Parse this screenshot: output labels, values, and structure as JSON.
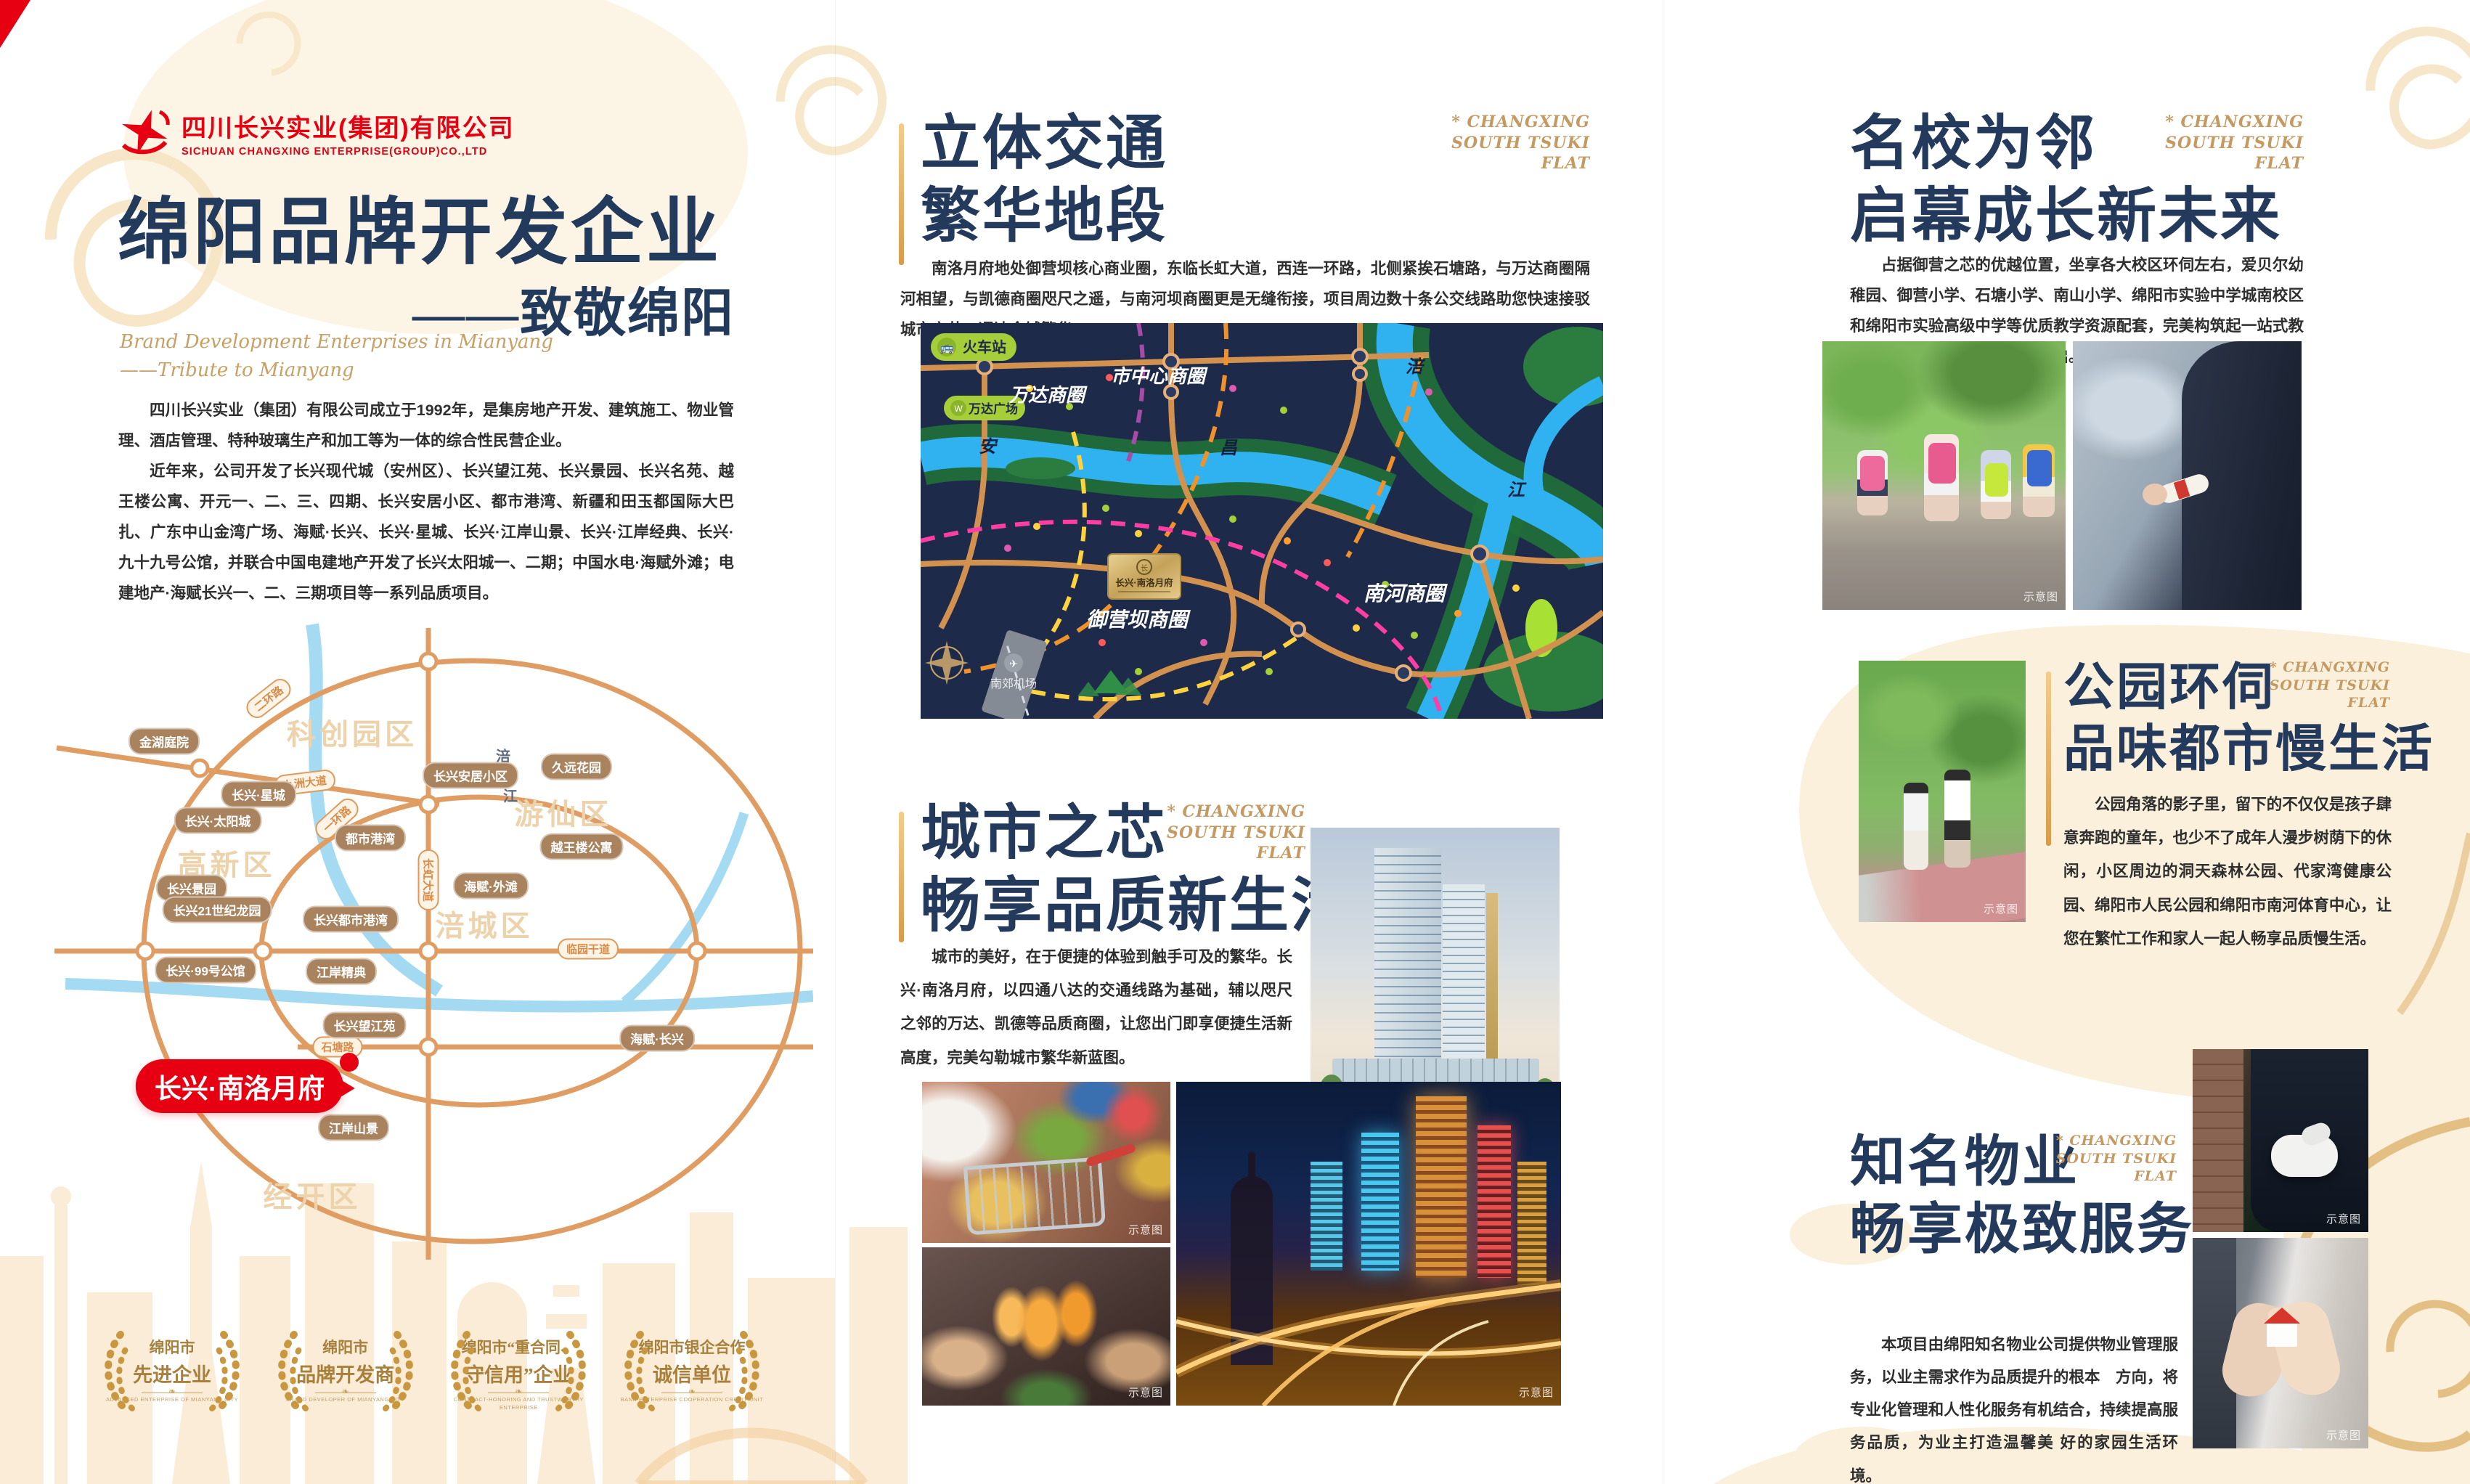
{
  "colors": {
    "accent_red": "#e60012",
    "navy_title": "#233a5c",
    "gold": "#c9a063",
    "map_road_orange": "#df9d63",
    "citymap_bg": "#1e2a4a",
    "green_pill": "#a6ce39",
    "cream": "#faf0dc"
  },
  "tag": {
    "l1": "* CHANGXING",
    "l2": "SOUTH TSUKI",
    "l3": "FLAT"
  },
  "watermarks": {
    "schematic": "示意图",
    "render": "效果图"
  },
  "logo": {
    "company_cn": "四川长兴实业(集团)有限公司",
    "company_en": "SICHUAN CHANGXING ENTERPRISE(GROUP)CO.,LTD"
  },
  "left": {
    "title": "绵阳品牌开发企业",
    "subtitle": "——致敬绵阳",
    "script1": "Brand Development Enterprises in Mianyang",
    "script2": "——Tribute to Mianyang",
    "para1": "四川长兴实业（集团）有限公司成立于1992年，是集房地产开发、建筑施工、物业管理、酒店管理、特种玻璃生产和加工等为一体的综合性民营企业。",
    "para2": "近年来，公司开发了长兴现代城（安州区）、长兴望江苑、长兴景园、长兴名苑、越王楼公寓、开元一、二、三、四期、长兴安居小区、都市港湾、新疆和田玉都国际大巴扎、广东中山金湾广场、海赋·长兴、长兴·星城、长兴·江岸山景、长兴·江岸经典、长兴·九十九号公馆，并联合中国电建地产开发了长兴太阳城一、二期；中国水电·海赋外滩；电建地产·海赋长兴一、二、三期项目等一系列品质项目。",
    "map": {
      "districts": [
        "科创园区",
        "游仙区",
        "高新区",
        "涪城区",
        "经开区"
      ],
      "roads": [
        "二环路",
        "九洲大道",
        "一环路",
        "长虹大道",
        "石塘路",
        "临园干道"
      ],
      "river_char1": "涪",
      "river_char2": "江",
      "projects": [
        "金湖庭院",
        "长兴·星城",
        "长兴·太阳城",
        "都市港湾",
        "长兴安居小区",
        "久远花园",
        "越王楼公寓",
        "海赋·外滩",
        "长兴景园",
        "长兴21世纪龙园",
        "长兴都市港湾",
        "长兴·99号公馆",
        "江岸精典",
        "长兴望江苑",
        "海赋·长兴",
        "江岸山景"
      ],
      "highlight": "长兴·南洛月府"
    },
    "badges": [
      {
        "line1": "绵阳市",
        "line2": "先进企业",
        "caption": "ADVANCED ENTERPRISE OF MIANYANG CITY"
      },
      {
        "line1": "绵阳市",
        "line2": "品牌开发商",
        "caption": "BRAND DEVELOPER OF MIANYANG CITY"
      },
      {
        "line1": "绵阳市“重合同、",
        "line2": "守信用”企业",
        "caption": "CONTRACT-HONORING AND TRUSTWORTHY ENTERPRISE"
      },
      {
        "line1": "绵阳市银企合作",
        "line2": "诚信单位",
        "caption": "BANK-ENTERPRISE COOPERATION CREDIT UNIT"
      }
    ]
  },
  "middle": {
    "s1": {
      "t1": "立体交通",
      "t2": "繁华地段",
      "para": "南洛月府地处御营坝核心商业圈，东临长虹大道，西连一环路，北侧紧挨石塘路，与万达商圈隔河相望，与凯德商圈咫尺之遥，与南河坝商圈更是无缝衔接，项目周边数十条公交线路助您快速接驳城市之芯，通达全城繁华。"
    },
    "map": {
      "station": "火车站",
      "wanda_plaza": "万达广场",
      "wanda_cbd": "万达商圈",
      "center_cbd": "市中心商圈",
      "nanhe_cbd": "南河商圈",
      "yuying_cbd": "御营坝商圈",
      "airport": "南郊机场",
      "river_an": "安",
      "river_chang": "昌",
      "river_fu": "涪",
      "river_jiang": "江",
      "plaque": "长兴·南洛月府"
    },
    "s2": {
      "t1": "城市之芯",
      "t2": "畅享品质新生活",
      "para": "城市的美好，在于便捷的体验到触手可及的繁华。长兴·南洛月府，以四通八达的交通线路为基础，辅以咫尺之邻的万达、凯德等品质商圈，让您出门即享便捷生活新高度，完美勾勒城市繁华新蓝图。"
    }
  },
  "right": {
    "s1": {
      "t1": "名校为邻",
      "t2": "启幕成长新未来",
      "para": "占据御营之芯的优越位置，坐享各大校区环伺左右，爱贝尔幼稚园、御营小学、石塘小学、南山小学、绵阳市实验中学城南校区和绵阳市实验高级中学等优质教学资源配套，完美构筑起一站式教育体系，璀璨未来，以智慧开启。"
    },
    "s2": {
      "t1": "公园环伺",
      "t2": "品味都市慢生活",
      "para": "公园角落的影子里，留下的不仅仅是孩子肆意奔跑的童年，也少不了成年人漫步树荫下的休闲，小区周边的洞天森林公园、代家湾健康公园、绵阳市人民公园和绵阳市南河体育中心，让您在繁忙工作和家人一起人畅享品质慢生活。"
    },
    "s3": {
      "t1": "知名物业",
      "t2": "畅享极致服务",
      "para": "本项目由绵阳知名物业公司提供物业管理服务，以业主需求作为品质提升的根本　方向，将专业化管理和人性化服务有机结合，持续提高服务品质，为业主打造温馨美 好的家园生活环境。"
    }
  }
}
